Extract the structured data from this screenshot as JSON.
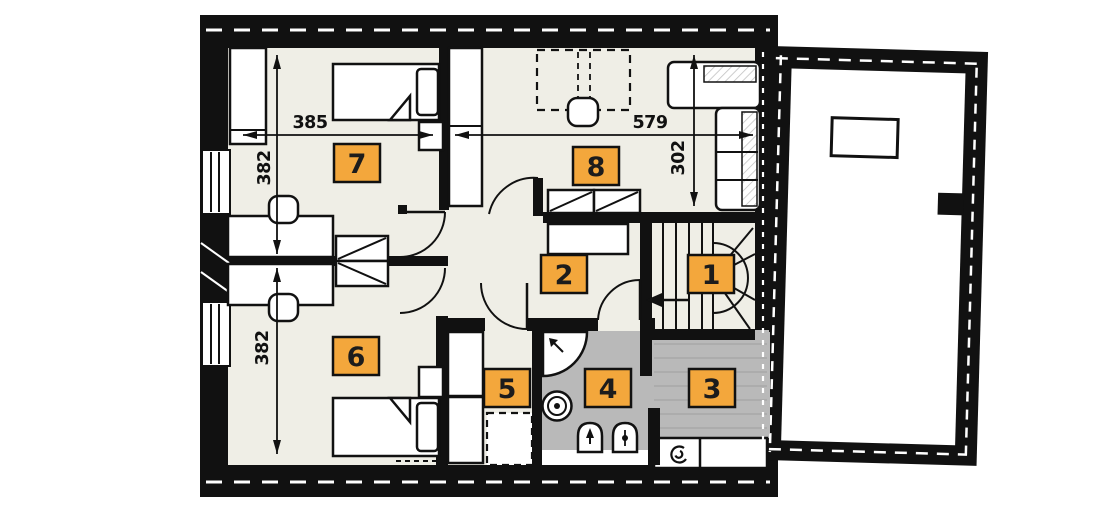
{
  "floor_plan": {
    "badges": [
      {
        "room": "1"
      },
      {
        "room": "2"
      },
      {
        "room": "3"
      },
      {
        "room": "4"
      },
      {
        "room": "5"
      },
      {
        "room": "6"
      },
      {
        "room": "7"
      },
      {
        "room": "8"
      }
    ],
    "dimensions": {
      "room7_width": "385",
      "room8_width": "579",
      "room7_height": "382",
      "room6_height": "382",
      "right_wing_height": "302"
    },
    "colors": {
      "wall": "#111111",
      "floor": "#efeee6",
      "wet_floor": "#b9b9b9",
      "badge_fill": "#f3a73c",
      "paper": "#ffffff"
    },
    "icons": [
      "fan-icon",
      "shower-icon",
      "washing-machine-icon",
      "toilet-icon",
      "bidet-icon",
      "stairs-direction-arrow-icon",
      "chimney-icon"
    ]
  }
}
